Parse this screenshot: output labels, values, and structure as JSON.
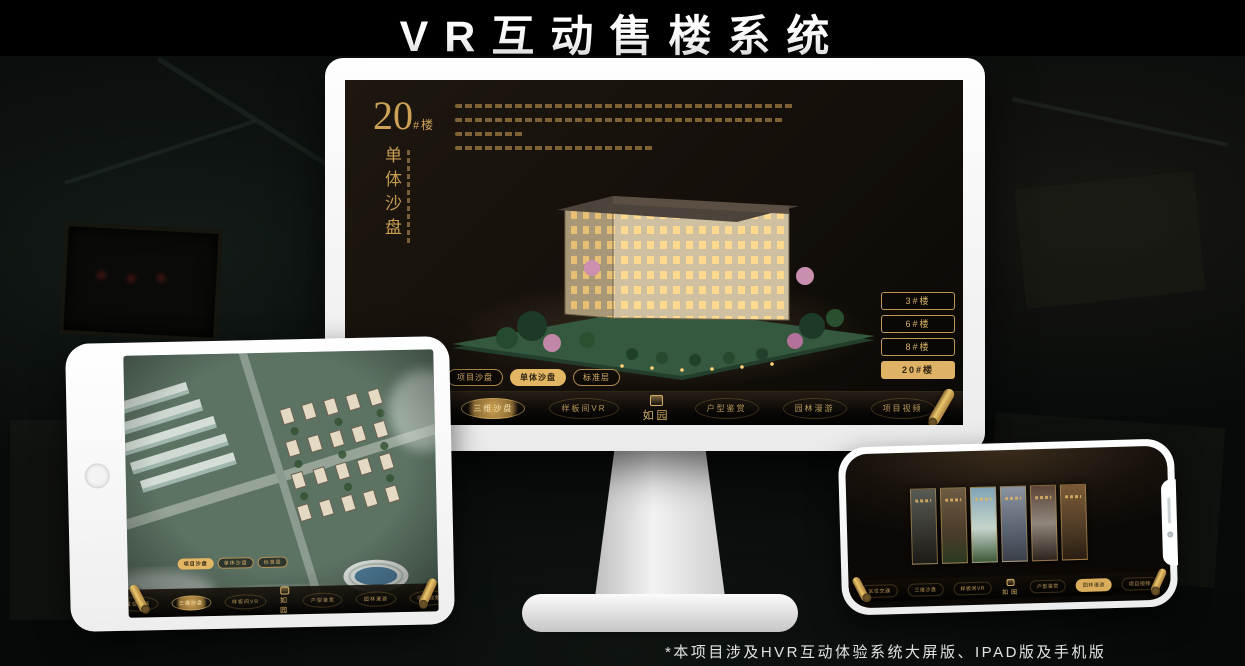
{
  "page": {
    "title": "VR互动售楼系统",
    "footnote": "*本项目涉及HVR互动体验系统大屏版、IPAD版及手机版"
  },
  "colors": {
    "gold": "#d2a55c",
    "gold_fill": "#e2b663",
    "screen_bg": "#17120d"
  },
  "monitor_app": {
    "block_title": {
      "number": "20",
      "suffix": "#楼",
      "caption": "单体沙盘"
    },
    "floor_buttons": [
      {
        "label": "3#楼",
        "selected": false
      },
      {
        "label": "6#楼",
        "selected": false
      },
      {
        "label": "8#楼",
        "selected": false
      },
      {
        "label": "20#楼",
        "selected": true
      }
    ],
    "view_tabs": [
      {
        "label": "项目沙盘",
        "selected": false
      },
      {
        "label": "单体沙盘",
        "selected": true
      },
      {
        "label": "标准层",
        "selected": false
      }
    ],
    "nav": {
      "left_items": [
        {
          "label": "区位交通",
          "active": false
        },
        {
          "label": "三维沙盘",
          "active": true
        },
        {
          "label": "样板间VR",
          "active": false
        }
      ],
      "logo": "如园",
      "right_items": [
        {
          "label": "户型鉴赏",
          "active": false
        },
        {
          "label": "园林漫游",
          "active": false
        },
        {
          "label": "项目视频",
          "active": false
        }
      ]
    }
  },
  "tablet_app": {
    "view_tabs": [
      {
        "label": "项目沙盘",
        "selected": true
      },
      {
        "label": "单体沙盘",
        "selected": false
      },
      {
        "label": "标准层",
        "selected": false
      }
    ],
    "nav": {
      "left_items": [
        {
          "label": "区位交通",
          "active": false
        },
        {
          "label": "三维沙盘",
          "active": true
        },
        {
          "label": "样板间VR",
          "active": false
        }
      ],
      "logo": "如园",
      "right_items": [
        {
          "label": "户型鉴赏",
          "active": false
        },
        {
          "label": "园林漫游",
          "active": false
        },
        {
          "label": "项目视频",
          "active": false
        }
      ]
    }
  },
  "phone_app": {
    "nav": {
      "left_items": [
        {
          "label": "区位交通",
          "active": false
        },
        {
          "label": "三维沙盘",
          "active": false
        },
        {
          "label": "样板间VR",
          "active": false
        }
      ],
      "logo": "如园",
      "right_items": [
        {
          "label": "户型鉴赏",
          "active": false
        },
        {
          "label": "园林漫游",
          "active": true
        },
        {
          "label": "项目视频",
          "active": false
        }
      ]
    }
  }
}
